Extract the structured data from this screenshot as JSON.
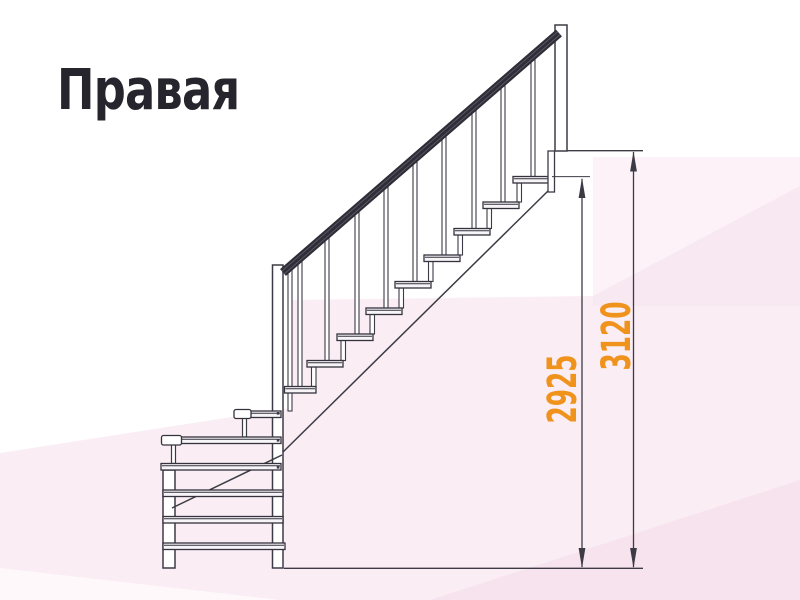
{
  "title": {
    "text": "Правая"
  },
  "drawing": {
    "type": "staircase-side-view",
    "stair_direction": "right",
    "dimension_labels": [
      {
        "name": "height-floor-to-top-step",
        "value": "2925"
      },
      {
        "name": "height-floor-to-landing",
        "value": "3120"
      }
    ],
    "accent_color": "#f0931d",
    "ink_color": "#3c3b45"
  },
  "background": {
    "tint_colors": [
      "#f8e8f2",
      "#faedf4",
      "#fdf2f8",
      "#f7e3ee",
      "#fef8fb"
    ]
  }
}
